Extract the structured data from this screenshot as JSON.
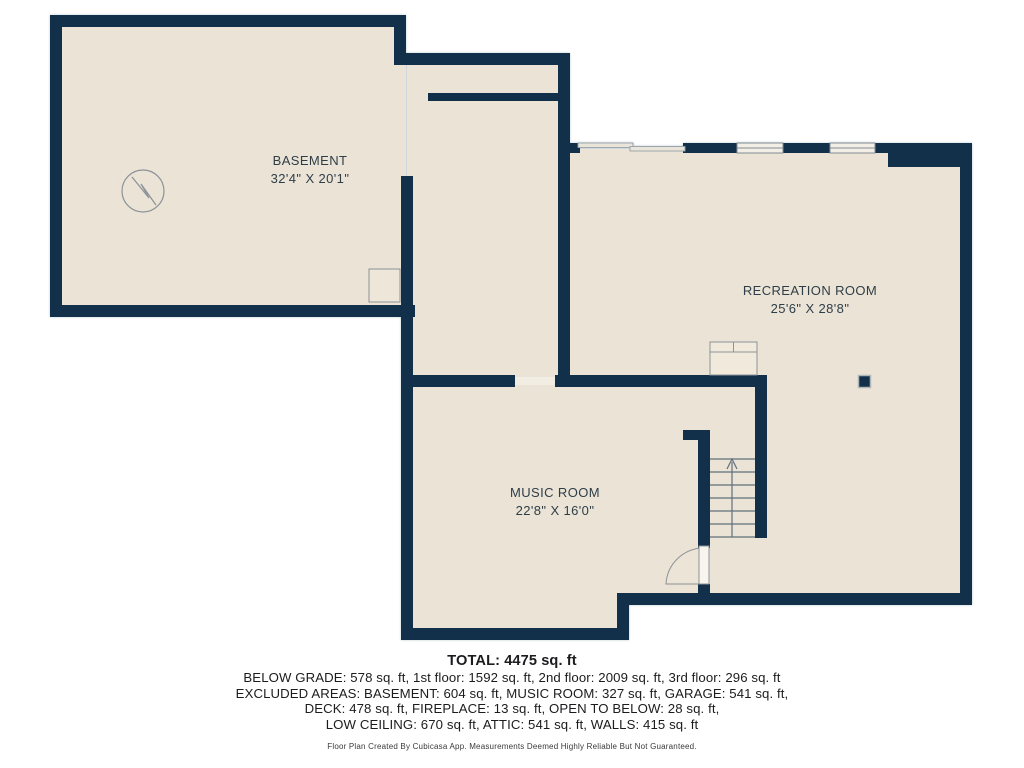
{
  "rooms": [
    {
      "name": "BASEMENT",
      "dims": "32'4\" X 20'1\""
    },
    {
      "name": "RECREATION ROOM",
      "dims": "25'6\" X 28'8\""
    },
    {
      "name": "MUSIC ROOM",
      "dims": "22'8\" X 16'0\""
    }
  ],
  "summary": {
    "total": "TOTAL: 4475 sq. ft",
    "line1": "BELOW GRADE: 578 sq. ft, 1st floor: 1592 sq. ft, 2nd floor: 2009 sq. ft, 3rd floor: 296 sq. ft",
    "line2": "EXCLUDED AREAS: BASEMENT: 604 sq. ft, MUSIC ROOM: 327 sq. ft, GARAGE: 541 sq. ft,",
    "line3": "DECK: 478 sq. ft, FIREPLACE: 13 sq. ft, OPEN TO BELOW: 28 sq. ft,",
    "line4": "LOW CEILING: 670 sq. ft, ATTIC: 541 sq. ft, WALLS: 415 sq. ft",
    "disclaimer": "Floor Plan Created By Cubicasa App. Measurements Deemed Highly Reliable But Not Guaranteed."
  },
  "colors": {
    "wall": "#13304a",
    "floor": "#ebe3d5",
    "opening_light": "#f2ede3",
    "symbol_stroke": "#8b9298",
    "label_text": "#2e3e49",
    "footer_text": "#1c1c1e"
  },
  "icons": {
    "sump-pump-icon": "circle with zigzag",
    "staircase-icon": "treads with up arrow",
    "door-swing-icon": "quarter-arc door",
    "window-icon": "double-line window",
    "sliding-door-icon": "offset rails",
    "column-icon": "filled square"
  }
}
